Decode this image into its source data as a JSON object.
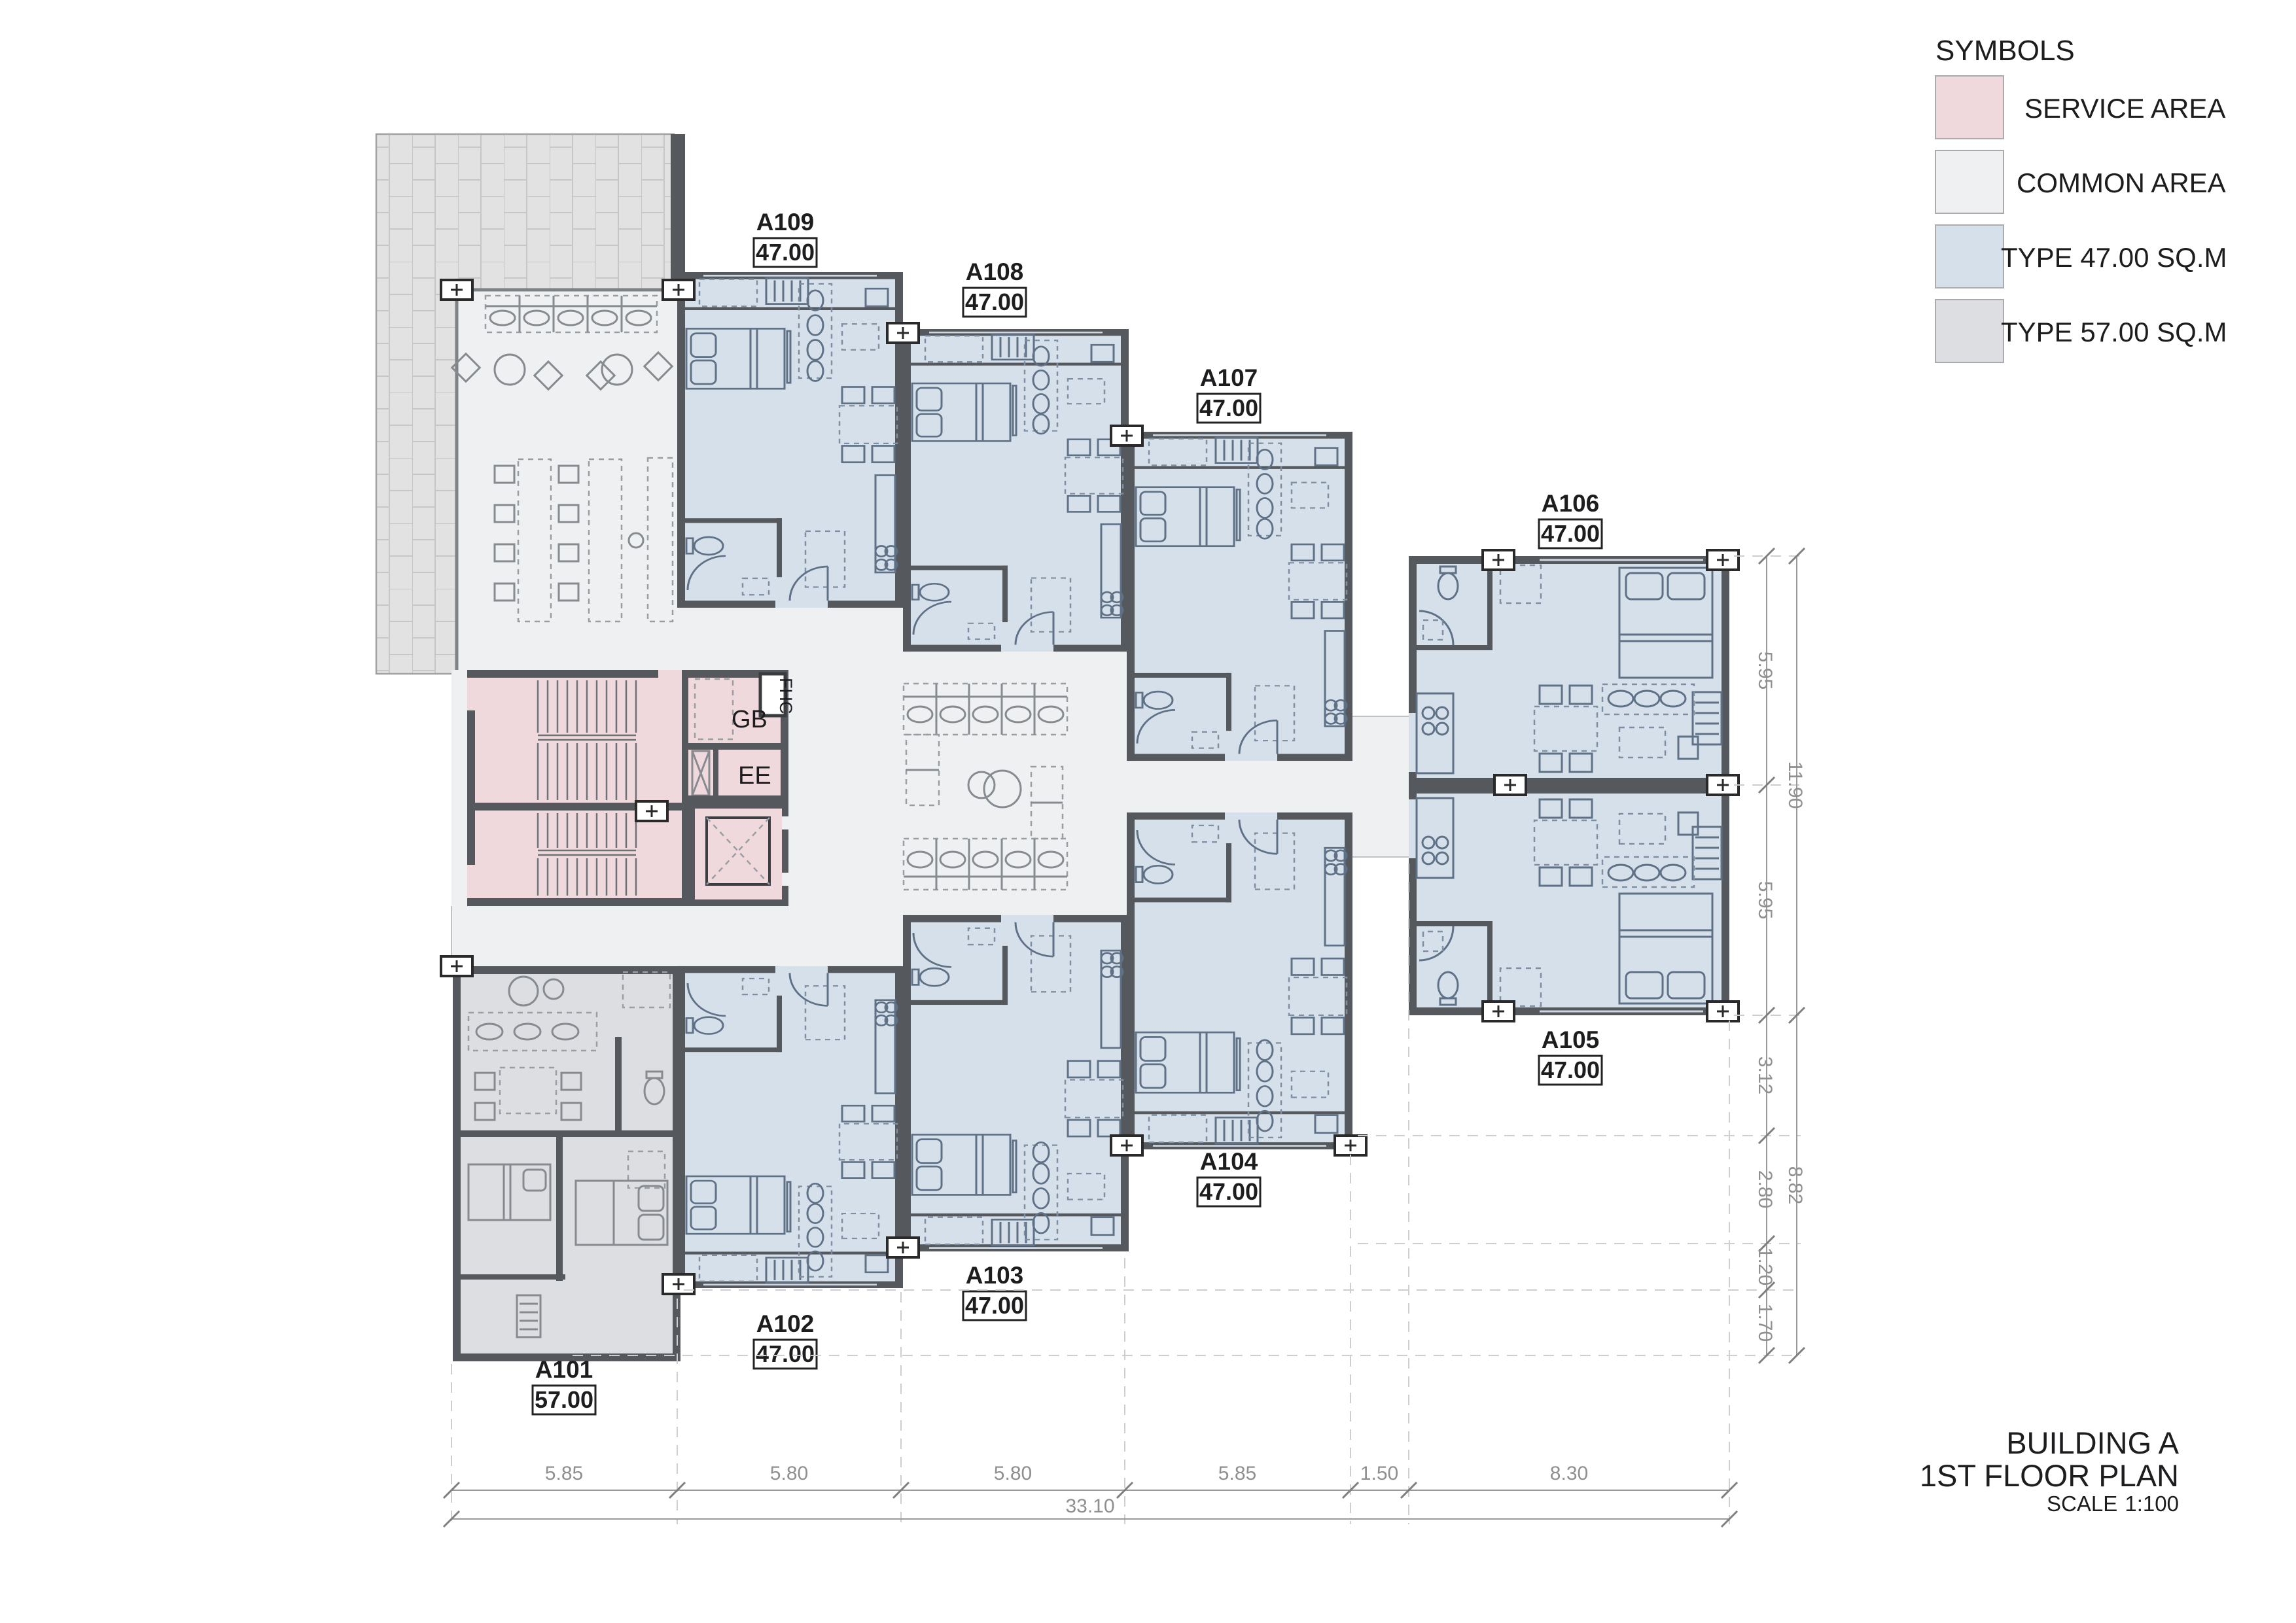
{
  "legend": {
    "title": "SYMBOLS",
    "items": [
      {
        "label": "SERVICE AREA",
        "color": "#efd9dc"
      },
      {
        "label": "COMMON AREA",
        "color": "#eef0f1"
      },
      {
        "label": "TYPE 47.00 SQ.M",
        "color": "#d6e0ea"
      },
      {
        "label": "TYPE 57.00 SQ.M",
        "color": "#dcdee1"
      }
    ]
  },
  "title_block": {
    "building": "BUILDING A",
    "floor": "1ST FLOOR PLAN",
    "scale_label": "SCALE",
    "scale_value": "1:100"
  },
  "rooms": {
    "gb": "GB",
    "ee": "EE",
    "fhc": "FHC"
  },
  "units": [
    {
      "id": "A101",
      "area": "57.00"
    },
    {
      "id": "A102",
      "area": "47.00"
    },
    {
      "id": "A103",
      "area": "47.00"
    },
    {
      "id": "A104",
      "area": "47.00"
    },
    {
      "id": "A105",
      "area": "47.00"
    },
    {
      "id": "A106",
      "area": "47.00"
    },
    {
      "id": "A107",
      "area": "47.00"
    },
    {
      "id": "A108",
      "area": "47.00"
    },
    {
      "id": "A109",
      "area": "47.00"
    }
  ],
  "dimensions": {
    "bottom": [
      "5.85",
      "5.80",
      "5.80",
      "5.85",
      "1.50",
      "8.30"
    ],
    "bottom_total": "33.10",
    "right_upper": [
      "5.95",
      "5.95"
    ],
    "right_upper_total": "11.90",
    "right_lower": [
      "3.12",
      "2.80",
      "1.20",
      "1.70"
    ],
    "right_lower_total": "8.82"
  },
  "colors": {
    "wall": "#55595d",
    "service_area": "#efd9dc",
    "common_area": "#eef0f1",
    "type_47": "#d6e0ea",
    "type_57": "#dcdee1",
    "terrace": "#e2e2e2"
  }
}
